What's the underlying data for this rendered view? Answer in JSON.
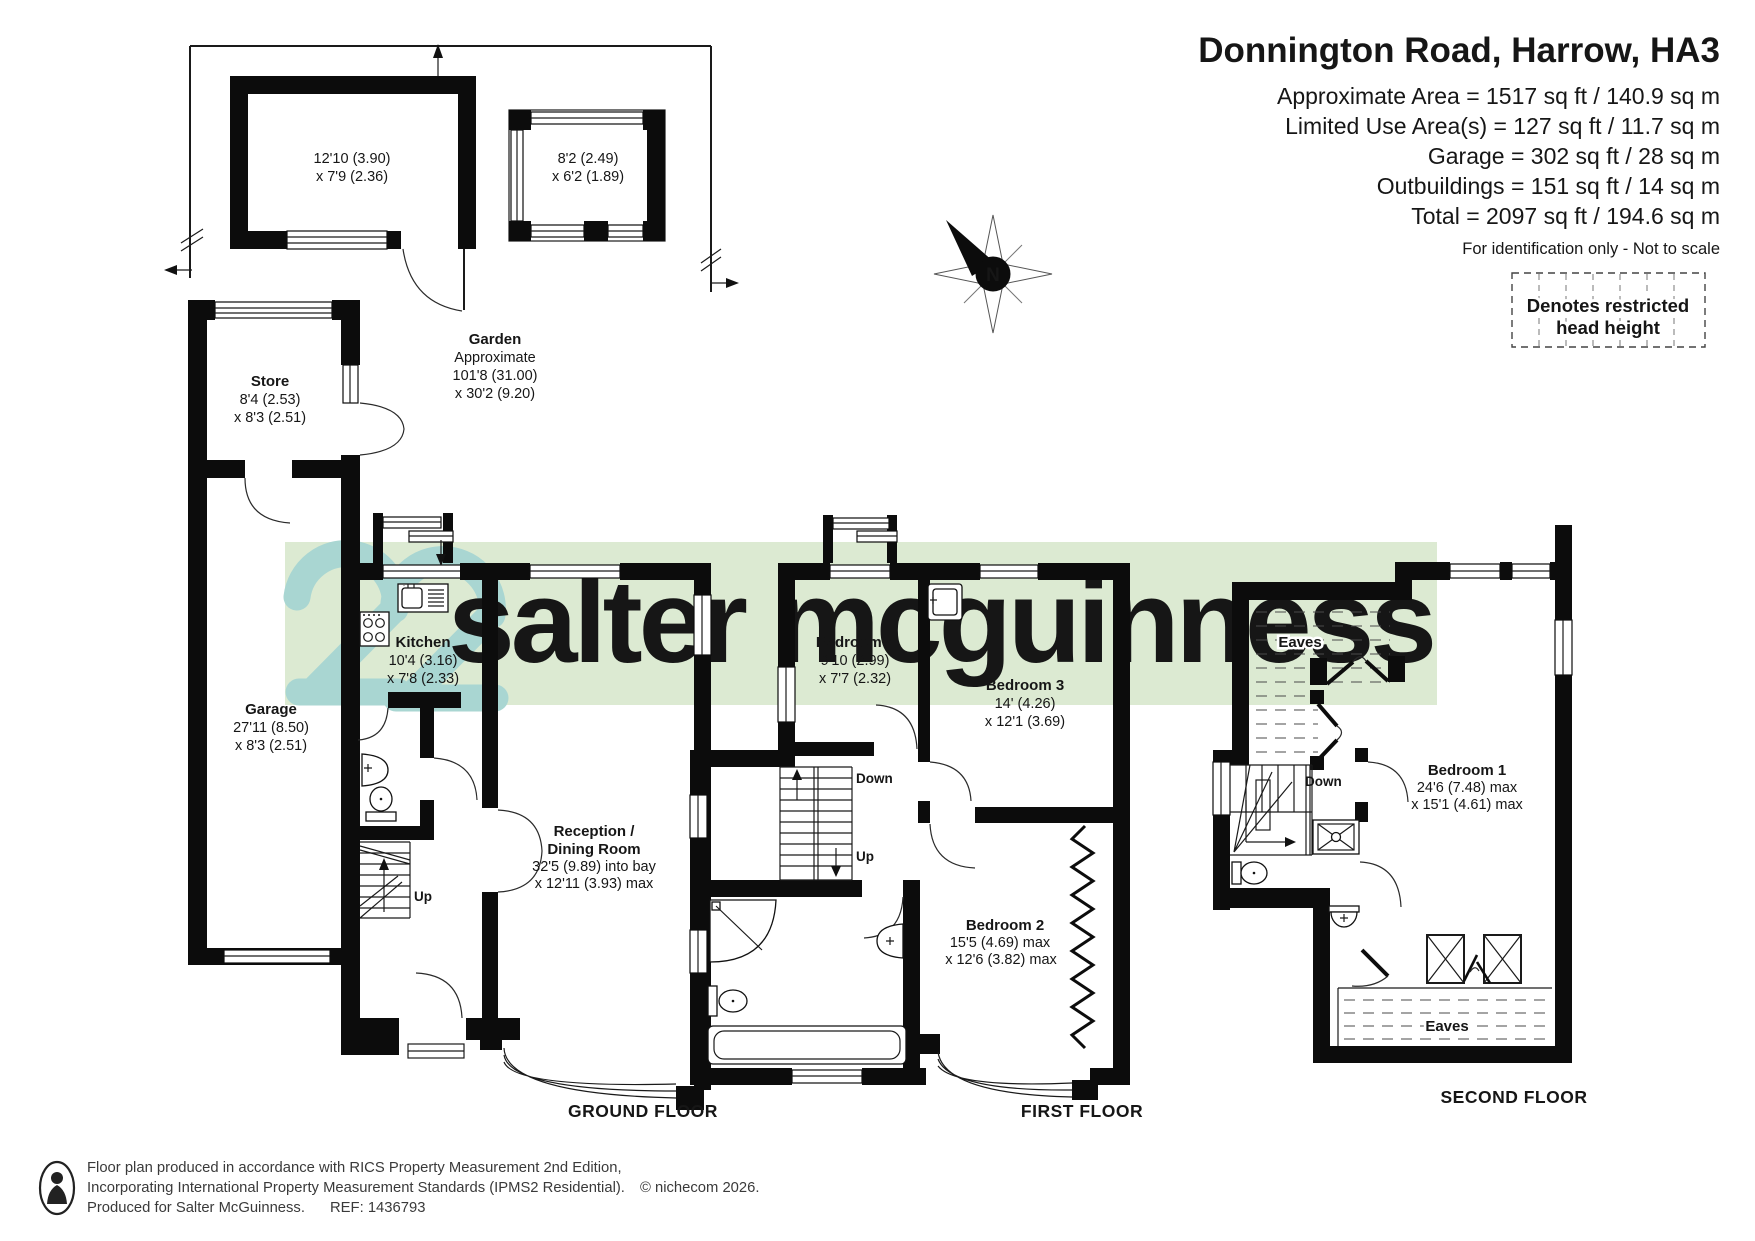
{
  "header": {
    "title": "Donnington Road, Harrow, HA3",
    "area_lines": [
      "Approximate Area = 1517 sq ft / 140.9 sq m",
      "Limited Use Area(s) = 127 sq ft / 11.7 sq m",
      "Garage = 302 sq ft / 28 sq m",
      "Outbuildings = 151 sq ft / 14 sq m",
      "Total = 2097 sq ft / 194.6 sq m"
    ],
    "disclaimer": "For identification only - Not to scale"
  },
  "legend": {
    "line1": "Denotes restricted",
    "line2": "head height"
  },
  "compass": {
    "north": "N"
  },
  "watermark": {
    "brand": "salter mcguinness"
  },
  "colors": {
    "band": "#dcead2",
    "logo_mark": "#a9d6d2",
    "logo_text": "#f6faf1"
  },
  "plans": {
    "ground": {
      "floor_label": "GROUND FLOOR",
      "outbuilding1": [
        "12'10 (3.90)",
        "x 7'9 (2.36)"
      ],
      "outbuilding2": [
        "8'2 (2.49)",
        "x 6'2 (1.89)"
      ],
      "garden": [
        "Garden",
        "Approximate",
        "101'8 (31.00)",
        "x 30'2 (9.20)"
      ],
      "store": [
        "Store",
        "8'4 (2.53)",
        "x 8'3 (2.51)"
      ],
      "garage": [
        "Garage",
        "27'11 (8.50)",
        "x 8'3 (2.51)"
      ],
      "kitchen": [
        "Kitchen",
        "10'4 (3.16)",
        "x 7'8 (2.33)"
      ],
      "reception": [
        "Reception /",
        "Dining Room",
        "32'5 (9.89) into bay",
        "x 12'11 (3.93) max"
      ],
      "up": "Up"
    },
    "first": {
      "floor_label": "FIRST FLOOR",
      "bedroom4": [
        "Bedroom 4",
        "9'10 (2.99)",
        "x 7'7 (2.32)"
      ],
      "bedroom3": [
        "Bedroom 3",
        "14' (4.26)",
        "x 12'1 (3.69)"
      ],
      "bedroom2": [
        "Bedroom 2",
        "15'5 (4.69) max",
        "x 12'6 (3.82) max"
      ],
      "down": "Down",
      "up": "Up"
    },
    "second": {
      "floor_label": "SECOND FLOOR",
      "bedroom1": [
        "Bedroom 1",
        "24'6 (7.48) max",
        "x 15'1 (4.61) max"
      ],
      "eaves_top": "Eaves",
      "eaves_bottom": "Eaves",
      "down": "Down"
    }
  },
  "footer": {
    "line1": "Floor plan produced in accordance with RICS Property Measurement 2nd Edition,",
    "line2": "Incorporating International Property Measurement Standards (IPMS2 Residential).",
    "copyright": "© nichecom 2026.",
    "line3": "Produced for Salter McGuinness.",
    "ref": "REF: 1436793"
  }
}
